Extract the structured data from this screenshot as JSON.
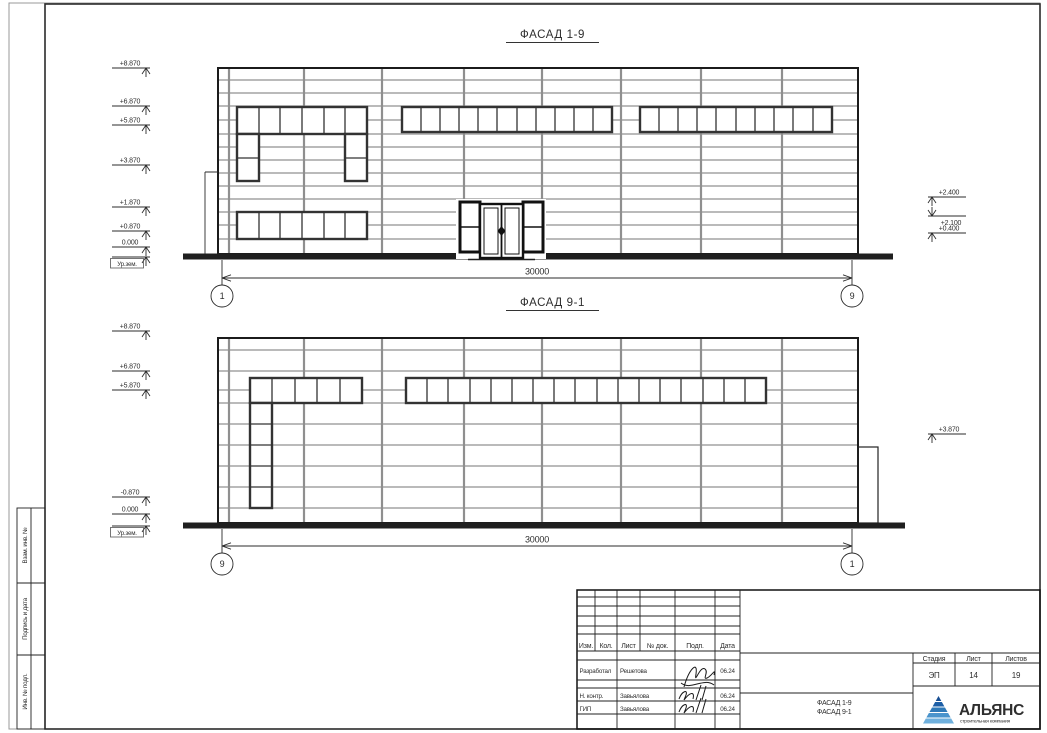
{
  "facade1": {
    "title": "ФАСАД 1-9",
    "dimension": "30000",
    "grid_left": "1",
    "grid_right": "9",
    "marks_left": [
      "+8.870",
      "+6.870",
      "+5.870",
      "+3.870",
      "+1.870",
      "+0.870",
      "0.000",
      "Ур.зем."
    ],
    "marks_right": [
      "+2.400",
      "+2.100",
      "+0.400"
    ]
  },
  "facade2": {
    "title": "ФАСАД 9-1",
    "dimension": "30000",
    "grid_left": "9",
    "grid_right": "1",
    "marks_left": [
      "+8.870",
      "+6.870",
      "+5.870",
      "-0.870",
      "0.000",
      "Ур.зем."
    ],
    "marks_right": [
      "+3.870"
    ]
  },
  "sidebar": {
    "labels": [
      "Взам. инв. №",
      "Подпись и дата",
      "Инв. № подл."
    ]
  },
  "titleblock": {
    "header": [
      "Изм.",
      "Кол.",
      "Лист",
      "№ док.",
      "Подп.",
      "Дата"
    ],
    "rows": [
      {
        "role": "Разработал",
        "name": "Решетова",
        "date": "06.24"
      },
      {
        "role": "Н. контр.",
        "name": "Завьялова",
        "date": "06.24"
      },
      {
        "role": "ГИП",
        "name": "Завьялова",
        "date": "06.24"
      }
    ],
    "stage_label": "Стадия",
    "sheet_label": "Лист",
    "sheets_label": "Листов",
    "stage": "ЭП",
    "sheet_no": "14",
    "sheets_total": "19",
    "doc_title_line1": "ФАСАД 1-9",
    "doc_title_line2": "ФАСАД 9-1",
    "logo": {
      "name": "АЛЬЯНС",
      "subtitle": "строительная компания",
      "color": "#1b5ea8"
    }
  }
}
